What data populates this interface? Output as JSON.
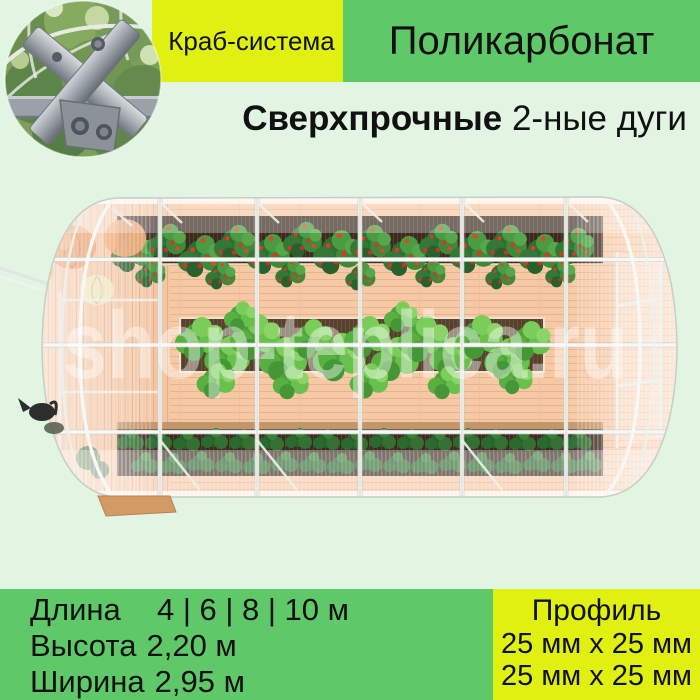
{
  "theme": {
    "background": "#e2f5e3",
    "accent_yellow": "#e0f011",
    "accent_green": "#5fc96a",
    "text": "#111111"
  },
  "header": {
    "crab_badge": "Краб-система",
    "material_badge": "Поликарбонат",
    "headline_bold": "Сверхпрочные",
    "headline_rest": "2-ные дуги"
  },
  "image": {
    "watermark": "shop-teplica.ru"
  },
  "specs": {
    "rows": [
      {
        "label": "Длина",
        "value": "4 | 6 | 8 | 10 м"
      },
      {
        "label": "Высота",
        "value": "2,20 м"
      },
      {
        "label": "Ширина",
        "value": "2,95 м"
      }
    ],
    "profile": {
      "title": "Профиль",
      "lines": [
        "25 мм х 25 мм",
        "25 мм х 25 мм"
      ]
    }
  }
}
